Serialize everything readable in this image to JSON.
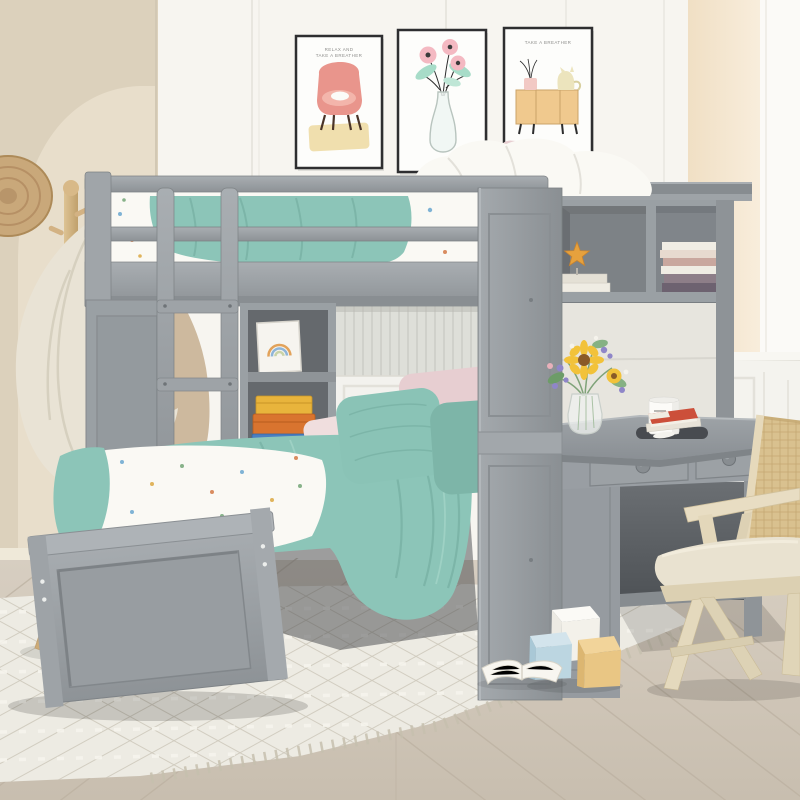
{
  "scene": {
    "description": "Gray wooden twin-over-twin L-shaped loft bunk bed with lower perpendicular bed, ladder, wardrobe panel, open shelves, bookcase hutch and built-in desk, styled in a kids bedroom with rattan chair, coat rack, wall art prints, patterned rug and chevron wood floor"
  },
  "palette": {
    "furniture-gray": "#9aa0a4",
    "furniture-gray-dark": "#868b8f",
    "furniture-interior": "#6e7377",
    "wall-white": "#f7f5f0",
    "wall-cream": "#dcd1bc",
    "wall-arch": "#e8decb",
    "wall-peach": "#f3e2c9",
    "teal-blanket": "#8cc5b8",
    "teal-dark": "#76b0a3",
    "bedding-white": "#faf9f4",
    "pink-pillow": "#e7ced1",
    "floor-wood": "#d2c9bb",
    "rug-base": "#edebe3",
    "rattan": "#d9c18f",
    "cushion": "#e9e2d0",
    "rack-wood": "#d3b283",
    "towel": "#e9e3d5",
    "starfish": "#e6a13d",
    "sunflower": "#f2c23a",
    "storage-box-yellow": "#e8b43c",
    "storage-box-orange": "#d9742f",
    "storage-box-blue": "#4a7fc1"
  },
  "wall_art": {
    "armchair_print": {
      "caption_line_1": "RELAX AND",
      "caption_line_2": "TAKE A BREATHER",
      "subject": "pink armchair with sleeping white cat"
    },
    "flower_print": {
      "subject": "pink poppies in a glass vase"
    },
    "cat_dresser_print": {
      "caption": "TAKE A BREATHER",
      "subject": "cat sitting on a wooden sideboard"
    }
  },
  "objects": [
    {
      "name": "loft-bunk-bed",
      "label": "gray loft bunk bed with guard rails"
    },
    {
      "name": "ladder",
      "label": "gray access ladder"
    },
    {
      "name": "wardrobe-panel",
      "label": "gray wardrobe side panel"
    },
    {
      "name": "open-shelf-unit",
      "label": "shelf with rainbow frame and storage boxes"
    },
    {
      "name": "hutch-bookcase",
      "label": "hutch cubbies with starfish and books"
    },
    {
      "name": "desk",
      "label": "built-in two-drawer desk"
    },
    {
      "name": "lower-bed",
      "label": "twin bed with teal quilt and pillows"
    },
    {
      "name": "rattan-chair",
      "label": "cane-back desk chair with cushion"
    },
    {
      "name": "coat-rack",
      "label": "wood coat stand with towel and hat"
    },
    {
      "name": "area-rug",
      "label": "cream geometric rug with fringe"
    },
    {
      "name": "toy-blocks",
      "label": "white, blue and yellow toy cubes"
    },
    {
      "name": "open-book",
      "label": "open book on rug"
    },
    {
      "name": "flower-vase",
      "label": "glass vase with sunflowers"
    },
    {
      "name": "mug",
      "label": "white mug on tray"
    }
  ]
}
